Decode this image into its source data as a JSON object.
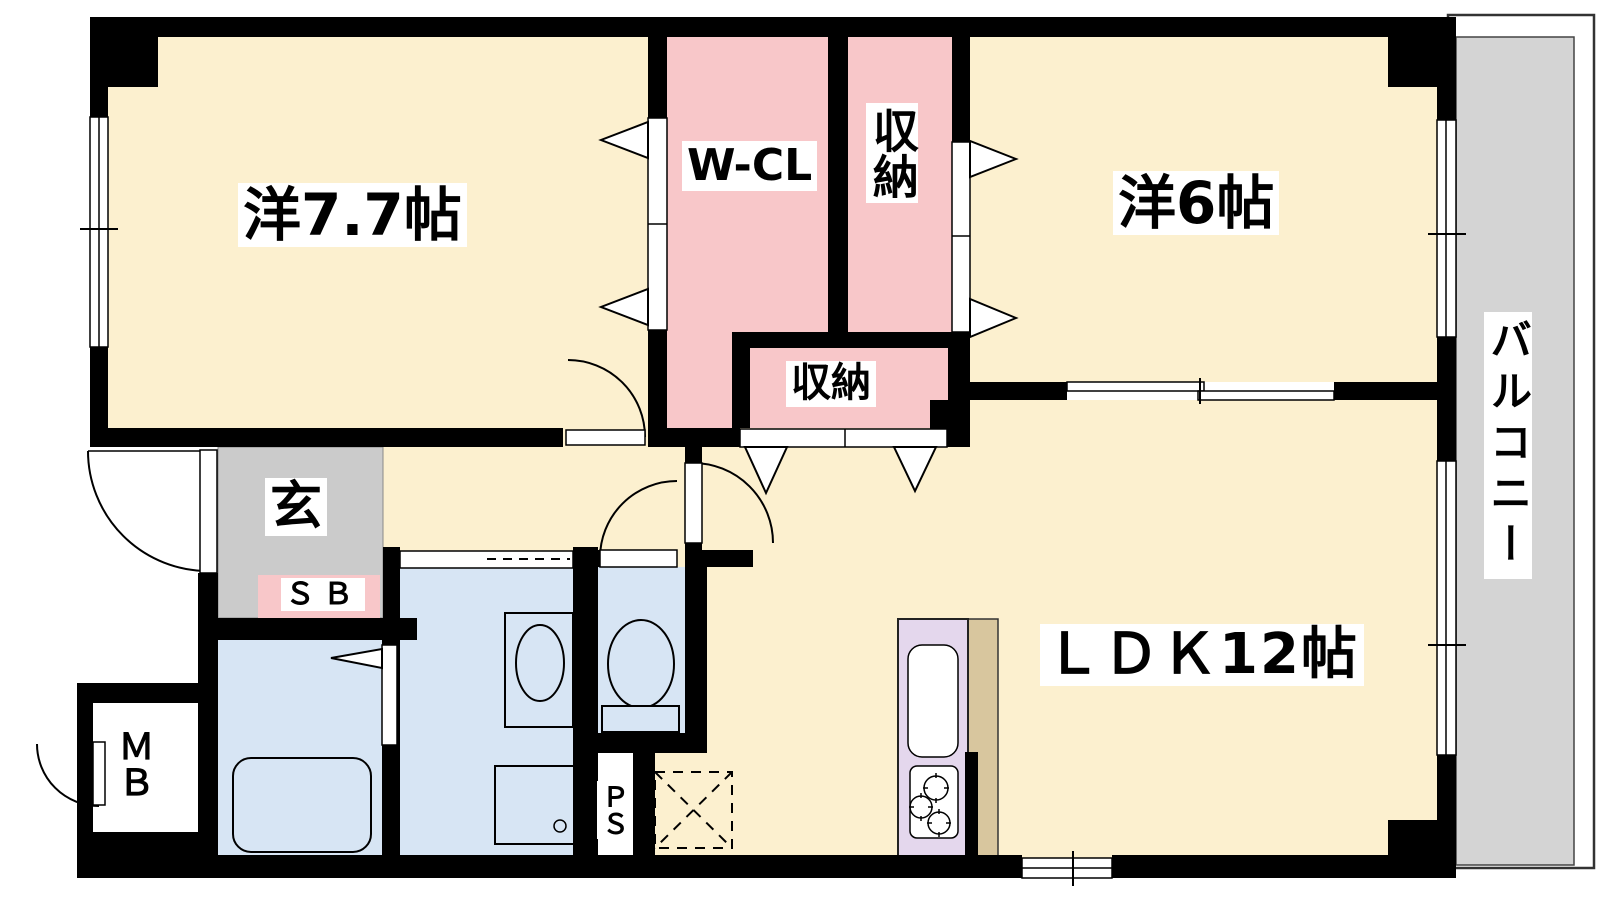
{
  "rooms": {
    "room77": {
      "label": "洋7.7帖",
      "type": "western-room",
      "size_jo": 7.7
    },
    "wcl": {
      "label": "W-CL",
      "type": "walk-in-closet"
    },
    "storage_upper": {
      "label": "収納",
      "type": "closet"
    },
    "room6": {
      "label": "洋6帖",
      "type": "western-room",
      "size_jo": 6
    },
    "storage_lower": {
      "label": "収納",
      "type": "closet"
    },
    "ldk": {
      "label": "ＬＤＫ12帖",
      "type": "living-dining-kitchen",
      "size_jo": 12
    },
    "genkan": {
      "label": "玄",
      "type": "entrance"
    },
    "shoe_box": {
      "label": "ＳＢ",
      "type": "shoe-box"
    },
    "meter_box": {
      "label": "ＭＢ",
      "type": "meter-box"
    },
    "pipe_space": {
      "label": "ＰＳ",
      "type": "pipe-space"
    },
    "balcony": {
      "label": "バルコニー",
      "type": "balcony"
    }
  },
  "colors": {
    "wall": "#000000",
    "room_floor": "#FCF0CF",
    "closet_pink": "#F8C7C9",
    "entry_gray": "#CBCBCB",
    "balcony_gray": "#D4D4D4",
    "wet_area_blue": "#D7E5F4",
    "kitchen_lavender": "#E4D7ED",
    "counter_tan": "#D8C69E",
    "fixture_white": "#FFFFFF"
  }
}
